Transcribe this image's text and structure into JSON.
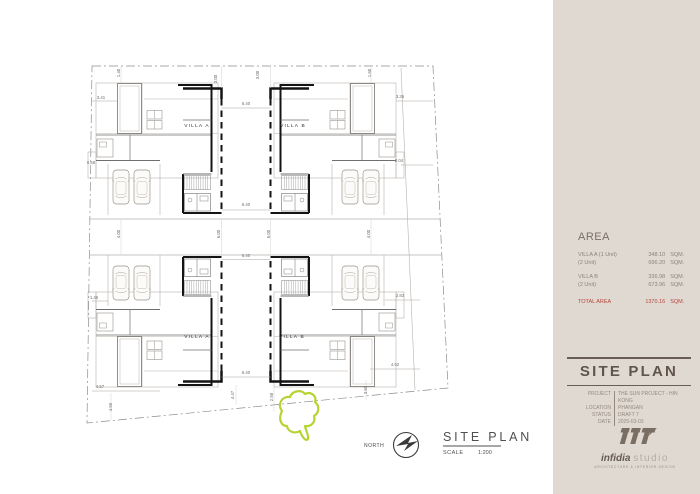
{
  "sidebar": {
    "bg": "#e0d9d2",
    "area": {
      "title": "AREA",
      "rows": [
        {
          "label": "VILLA A (1 Unit)",
          "value": "348.10",
          "unit": "SQM."
        },
        {
          "label": "(2 Unit)",
          "value": "696.20",
          "unit": "SQM."
        },
        {
          "label": "VILLA B",
          "value": "336.98",
          "unit": "SQM."
        },
        {
          "label": "(2 Unit)",
          "value": "673.96",
          "unit": "SQM."
        }
      ],
      "total": {
        "label": "TOTAL AREA",
        "value": "1370.16",
        "unit": "SQM.",
        "color": "#b5453c"
      }
    },
    "titleblock": {
      "title": "SITE PLAN",
      "info": [
        {
          "label": "PROJECT",
          "value": "THE SUN PROJECT - HIN KONG"
        },
        {
          "label": "LOCATION",
          "value": "PHANGAN"
        },
        {
          "label": "STATUS",
          "value": "DRAFT 7"
        },
        {
          "label": "DATE",
          "value": "2025-03-03"
        }
      ]
    },
    "logo": {
      "name_bold": "infidia",
      "name_light": "studio",
      "tagline": "ARCHITECTURE & INTERIOR DESIGN"
    }
  },
  "drawing": {
    "villa_labels": [
      {
        "text": "VILLA A",
        "x": 197,
        "y": 127
      },
      {
        "text": "VILLA B",
        "x": 293,
        "y": 127
      },
      {
        "text": "VILLA A",
        "x": 197,
        "y": 338
      },
      {
        "text": "VILLA B",
        "x": 292,
        "y": 338
      }
    ],
    "dimensions": [
      {
        "t": "3.41",
        "x": 101,
        "y": 99,
        "r": 0
      },
      {
        "t": "1.40",
        "x": 120,
        "y": 73,
        "r": 90
      },
      {
        "t": "3.00",
        "x": 217,
        "y": 79,
        "r": 90
      },
      {
        "t": "3.00",
        "x": 259,
        "y": 75,
        "r": 90
      },
      {
        "t": "6.40",
        "x": 246,
        "y": 105,
        "r": 0
      },
      {
        "t": "1.60",
        "x": 371,
        "y": 73,
        "r": 90
      },
      {
        "t": "3.36",
        "x": 400,
        "y": 98,
        "r": 0
      },
      {
        "t": "0.58",
        "x": 91,
        "y": 164,
        "r": 0
      },
      {
        "t": "2.04",
        "x": 399,
        "y": 162,
        "r": 0
      },
      {
        "t": "4.00",
        "x": 120,
        "y": 234,
        "r": 90
      },
      {
        "t": "6.00",
        "x": 220,
        "y": 234,
        "r": 90
      },
      {
        "t": "6.00",
        "x": 270,
        "y": 234,
        "r": 90
      },
      {
        "t": "4.00",
        "x": 370,
        "y": 234,
        "r": 90
      },
      {
        "t": "6.40",
        "x": 246,
        "y": 206,
        "r": 0
      },
      {
        "t": "6.40",
        "x": 246,
        "y": 257,
        "r": 0
      },
      {
        "t": "6.40",
        "x": 246,
        "y": 374,
        "r": 0
      },
      {
        "t": "1.46",
        "x": 94,
        "y": 299,
        "r": 0
      },
      {
        "t": "4.57",
        "x": 100,
        "y": 388,
        "r": 0
      },
      {
        "t": "4.55",
        "x": 112,
        "y": 407,
        "r": 90
      },
      {
        "t": "4.47",
        "x": 234,
        "y": 395,
        "r": 90
      },
      {
        "t": "2.58",
        "x": 273,
        "y": 397,
        "r": 90
      },
      {
        "t": "3.50",
        "x": 367,
        "y": 390,
        "r": 90
      },
      {
        "t": "2.83",
        "x": 400,
        "y": 297,
        "r": 0
      },
      {
        "t": "4.92",
        "x": 395,
        "y": 366,
        "r": 0
      }
    ],
    "compass_label": "NORTH",
    "title": "SITE PLAN",
    "scale_label": "SCALE",
    "scale_value": "1:200",
    "highlight_color": "#b5d434"
  }
}
